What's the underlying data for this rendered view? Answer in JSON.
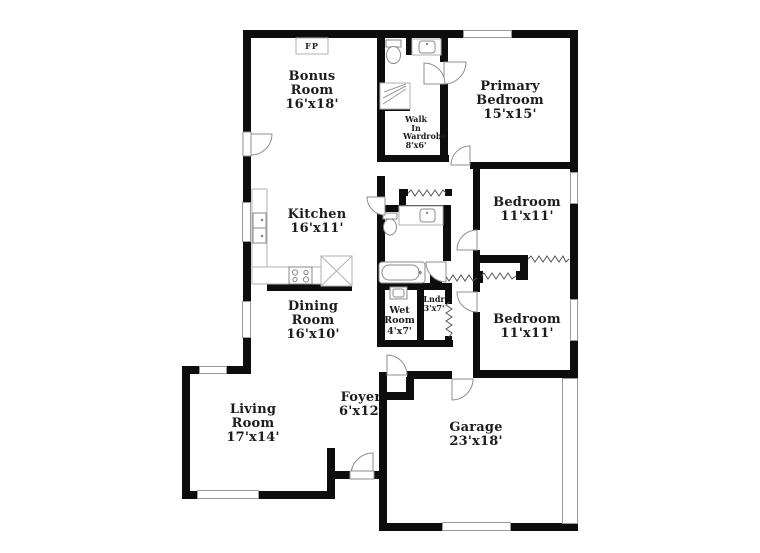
{
  "rooms": {
    "bonus": {
      "name": "Bonus Room",
      "dims": "16'x18'"
    },
    "primary": {
      "name": "Primary Bedroom",
      "dims": "15'x15'"
    },
    "wardrobe": {
      "name": "Walk In Wardrobe",
      "dims": "8'x6'"
    },
    "kitchen": {
      "name": "Kitchen",
      "dims": "16'x11'"
    },
    "bedroom1": {
      "name": "Bedroom",
      "dims": "11'x11'"
    },
    "dining": {
      "name": "Dining Room",
      "dims": "16'x10'"
    },
    "wet": {
      "name": "Wet Room",
      "dims": "4'x7'"
    },
    "laundry": {
      "name": "Lndr",
      "dims": "3'x7'"
    },
    "bedroom2": {
      "name": "Bedroom",
      "dims": "11'x11'"
    },
    "foyer": {
      "name": "Foyer",
      "dims": "6'x12'"
    },
    "living": {
      "name": "Living Room",
      "dims": "17'x14'"
    },
    "garage": {
      "name": "Garage",
      "dims": "23'x18'"
    }
  },
  "annotations": {
    "fireplace": "FP"
  },
  "colors": {
    "wall": "#0d0d0d",
    "background": "#ffffff",
    "fixture_outline": "#8f8f8f",
    "text": "#1c1c1c"
  }
}
